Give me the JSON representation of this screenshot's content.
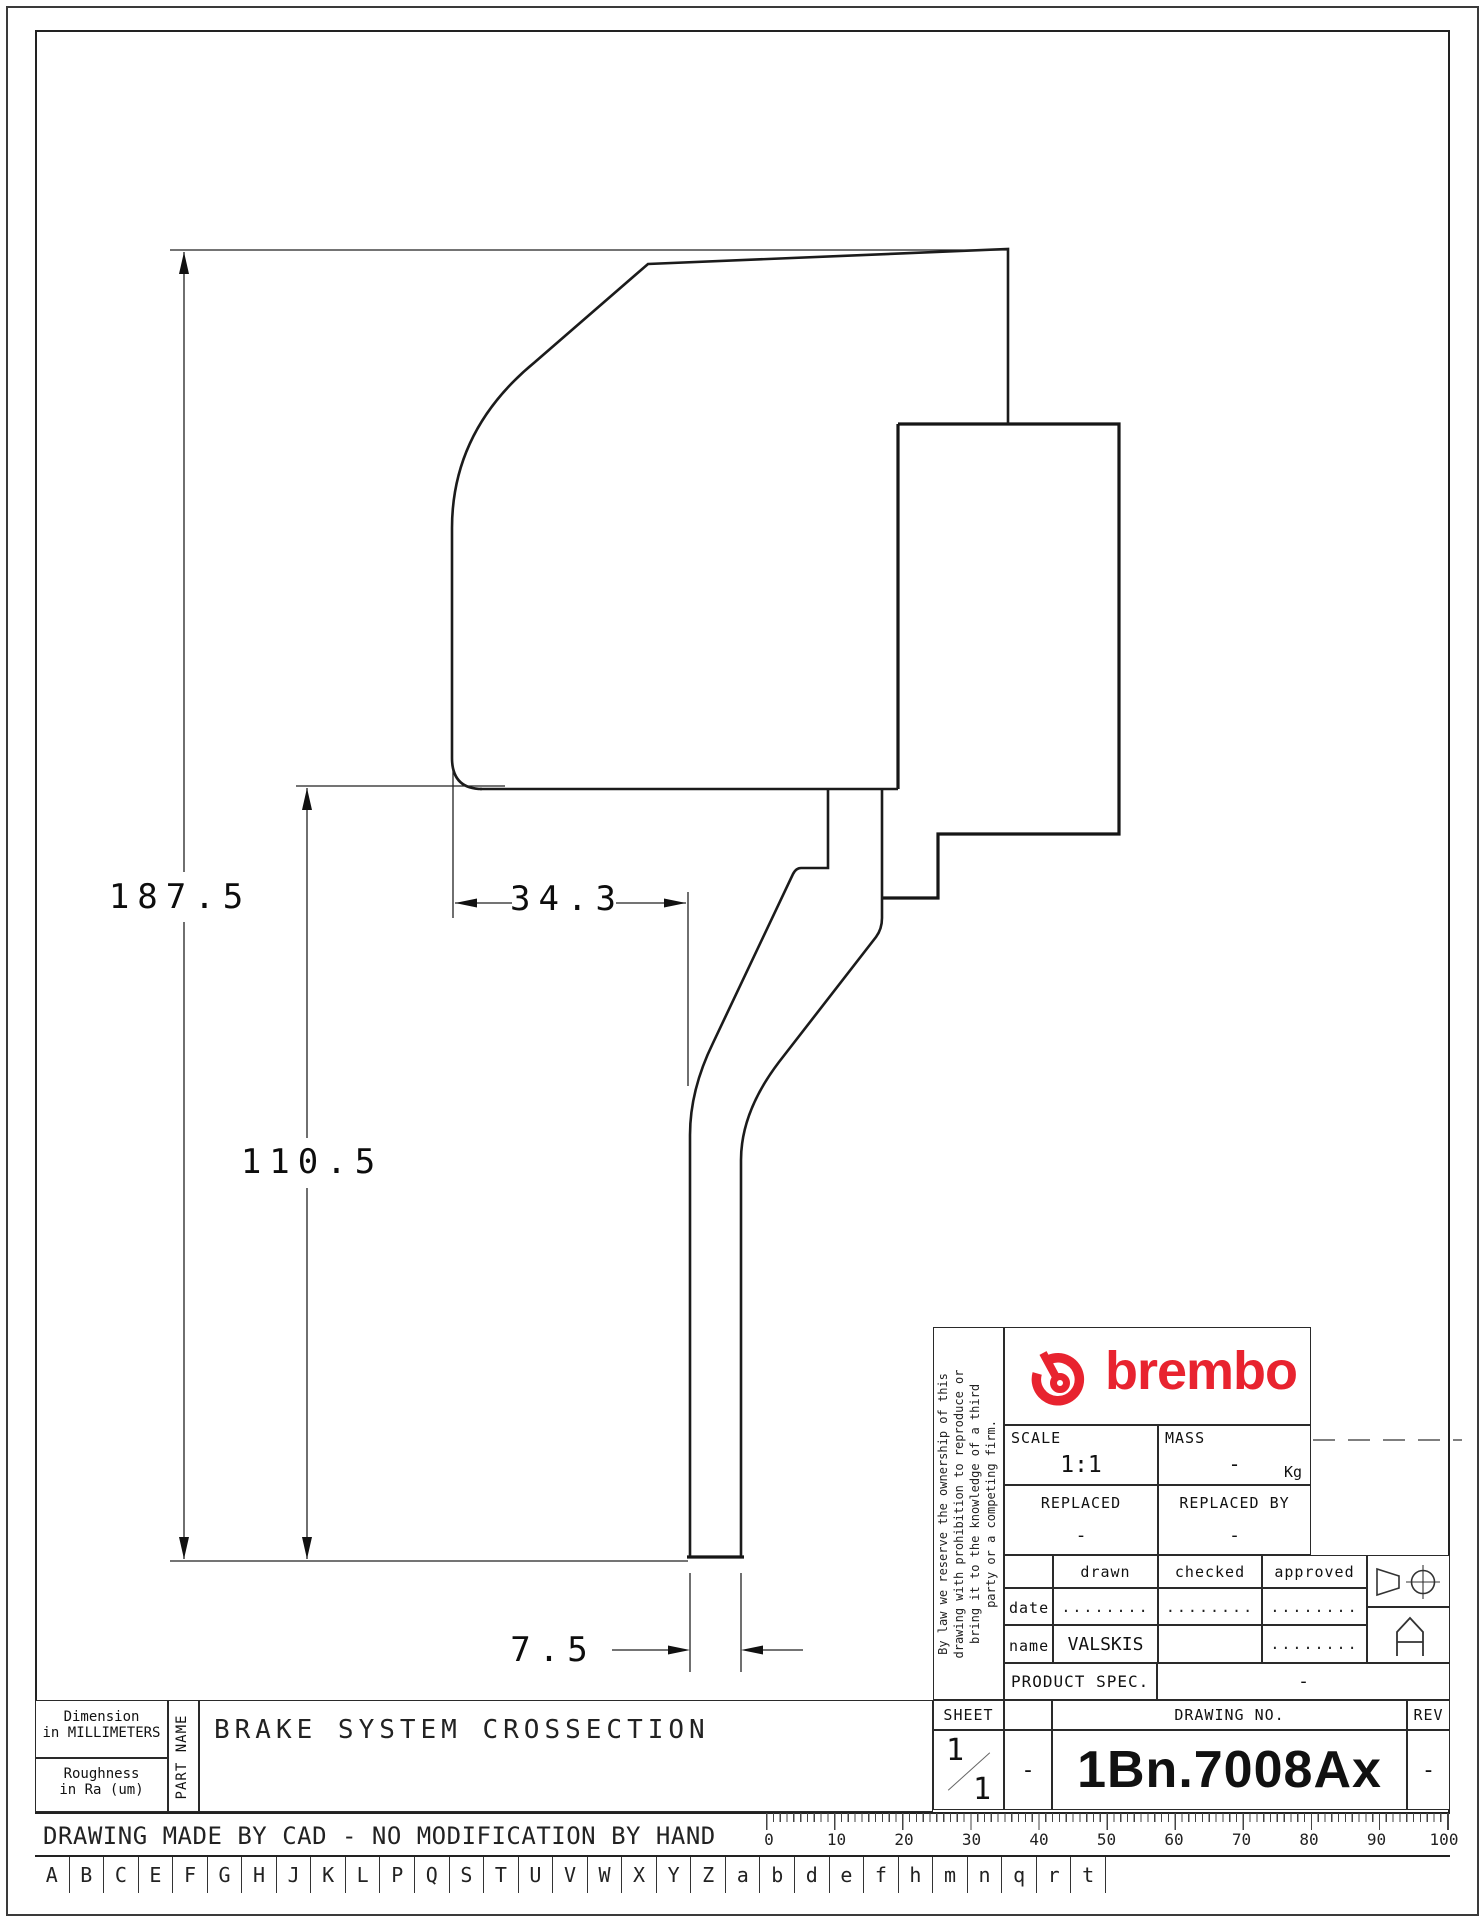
{
  "dimensions": {
    "overall_height": "187.5",
    "lower_height": "110.5",
    "body_width": "34.3",
    "stem_width": "7.5"
  },
  "title_block": {
    "brand": "brembo",
    "brand_color": "#e8232f",
    "ownership_text": "By law we reserve the ownership of this\ndrawing with prohibition to reproduce or\nbring it to the knowledge of a third\nparty or a competing firm.",
    "scale_label": "SCALE",
    "scale_value": "1:1",
    "mass_label": "MASS",
    "mass_value": "-",
    "mass_unit": "Kg",
    "replaced_label": "REPLACED",
    "replaced_value": "-",
    "replaced_by_label": "REPLACED BY",
    "replaced_by_value": "-",
    "col_drawn": "drawn",
    "col_checked": "checked",
    "col_approved": "approved",
    "row_date": "date",
    "row_name": "name",
    "date_drawn": "........",
    "date_checked": "........",
    "date_approved": "........",
    "name_drawn": "VALSKIS",
    "name_checked": "",
    "name_approved": "........",
    "product_spec_label": "PRODUCT SPEC.",
    "product_spec_value": "-",
    "sheet_label": "SHEET",
    "sheet_num": "1",
    "sheet_total": "1",
    "dash_cell": "-",
    "drawing_no_label": "DRAWING NO.",
    "drawing_no": "1Bn.7008Ax",
    "rev_label": "REV",
    "rev_value": "-"
  },
  "info_panel": {
    "dimension_note_l1": "Dimension",
    "dimension_note_l2": "in MILLIMETERS",
    "roughness_l1": "Roughness",
    "roughness_l2": "in Ra (um)",
    "part_name_label": "PART NAME",
    "part_title": "BRAKE SYSTEM CROSSECTION"
  },
  "footer": {
    "cad_note": "DRAWING MADE BY CAD - NO MODIFICATION BY HAND",
    "letters": [
      "A",
      "B",
      "C",
      "E",
      "F",
      "G",
      "H",
      "J",
      "K",
      "L",
      "P",
      "Q",
      "S",
      "T",
      "U",
      "V",
      "W",
      "X",
      "Y",
      "Z",
      "a",
      "b",
      "d",
      "e",
      "f",
      "h",
      "m",
      "n",
      "q",
      "r",
      "t"
    ],
    "ruler_marks": [
      "0",
      "10",
      "20",
      "30",
      "40",
      "50",
      "60",
      "70",
      "80",
      "90",
      "100"
    ]
  }
}
